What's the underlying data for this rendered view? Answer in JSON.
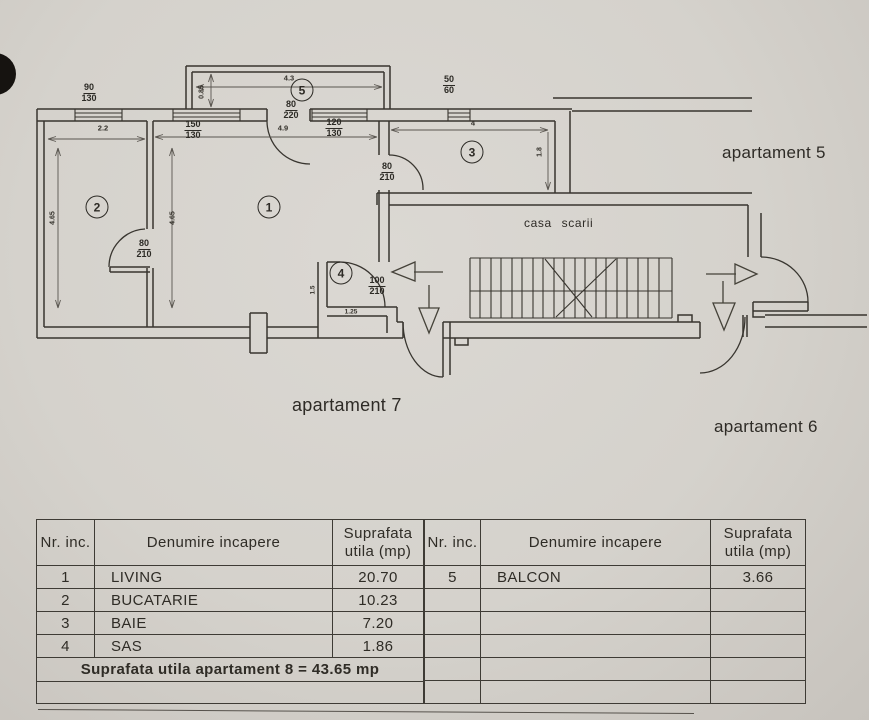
{
  "plan": {
    "apartments": {
      "ap5": "apartament 5",
      "ap6": "apartament 6",
      "ap7": "apartament 7"
    },
    "stairwell_label": "casa scarii",
    "rooms": {
      "r1": "1",
      "r2": "2",
      "r3": "3",
      "r4": "4",
      "r5": "5"
    },
    "openings": {
      "win_90_130": {
        "w": "90",
        "h": "130"
      },
      "win_150_130": {
        "w": "150",
        "h": "130"
      },
      "door_80_220": {
        "w": "80",
        "h": "220"
      },
      "win_120_130": {
        "w": "120",
        "h": "130"
      },
      "win_50_60": {
        "w": "50",
        "h": "60"
      },
      "door_80_210_kitchen": {
        "w": "80",
        "h": "210"
      },
      "door_80_210_bath": {
        "w": "80",
        "h": "210"
      },
      "door_100_210_entry": {
        "w": "100",
        "h": "210"
      }
    },
    "dimensions": {
      "kitchen_width": "2.2",
      "living_width": "4.9",
      "bath_width": "4",
      "balcony_width": "4.3",
      "balcony_depth": "0.85",
      "kitchen_depth": "4.65",
      "living_depth": "4.65",
      "bath_depth": "1.8",
      "sas_depth": "1.5",
      "sas_width": "1.25"
    }
  },
  "table": {
    "headers": {
      "nr": "Nr. inc.",
      "name": "Denumire incapere",
      "area_line1": "Suprafata",
      "area_line2": "utila (mp)"
    },
    "left_rows": [
      {
        "nr": "1",
        "name": "LIVING",
        "area": "20.70"
      },
      {
        "nr": "2",
        "name": "BUCATARIE",
        "area": "10.23"
      },
      {
        "nr": "3",
        "name": "BAIE",
        "area": "7.20"
      },
      {
        "nr": "4",
        "name": "SAS",
        "area": "1.86"
      }
    ],
    "total_row": "Suprafata utila apartament 8 = 43.65 mp",
    "right_rows": [
      {
        "nr": "5",
        "name": "BALCON",
        "area": "3.66"
      }
    ]
  }
}
